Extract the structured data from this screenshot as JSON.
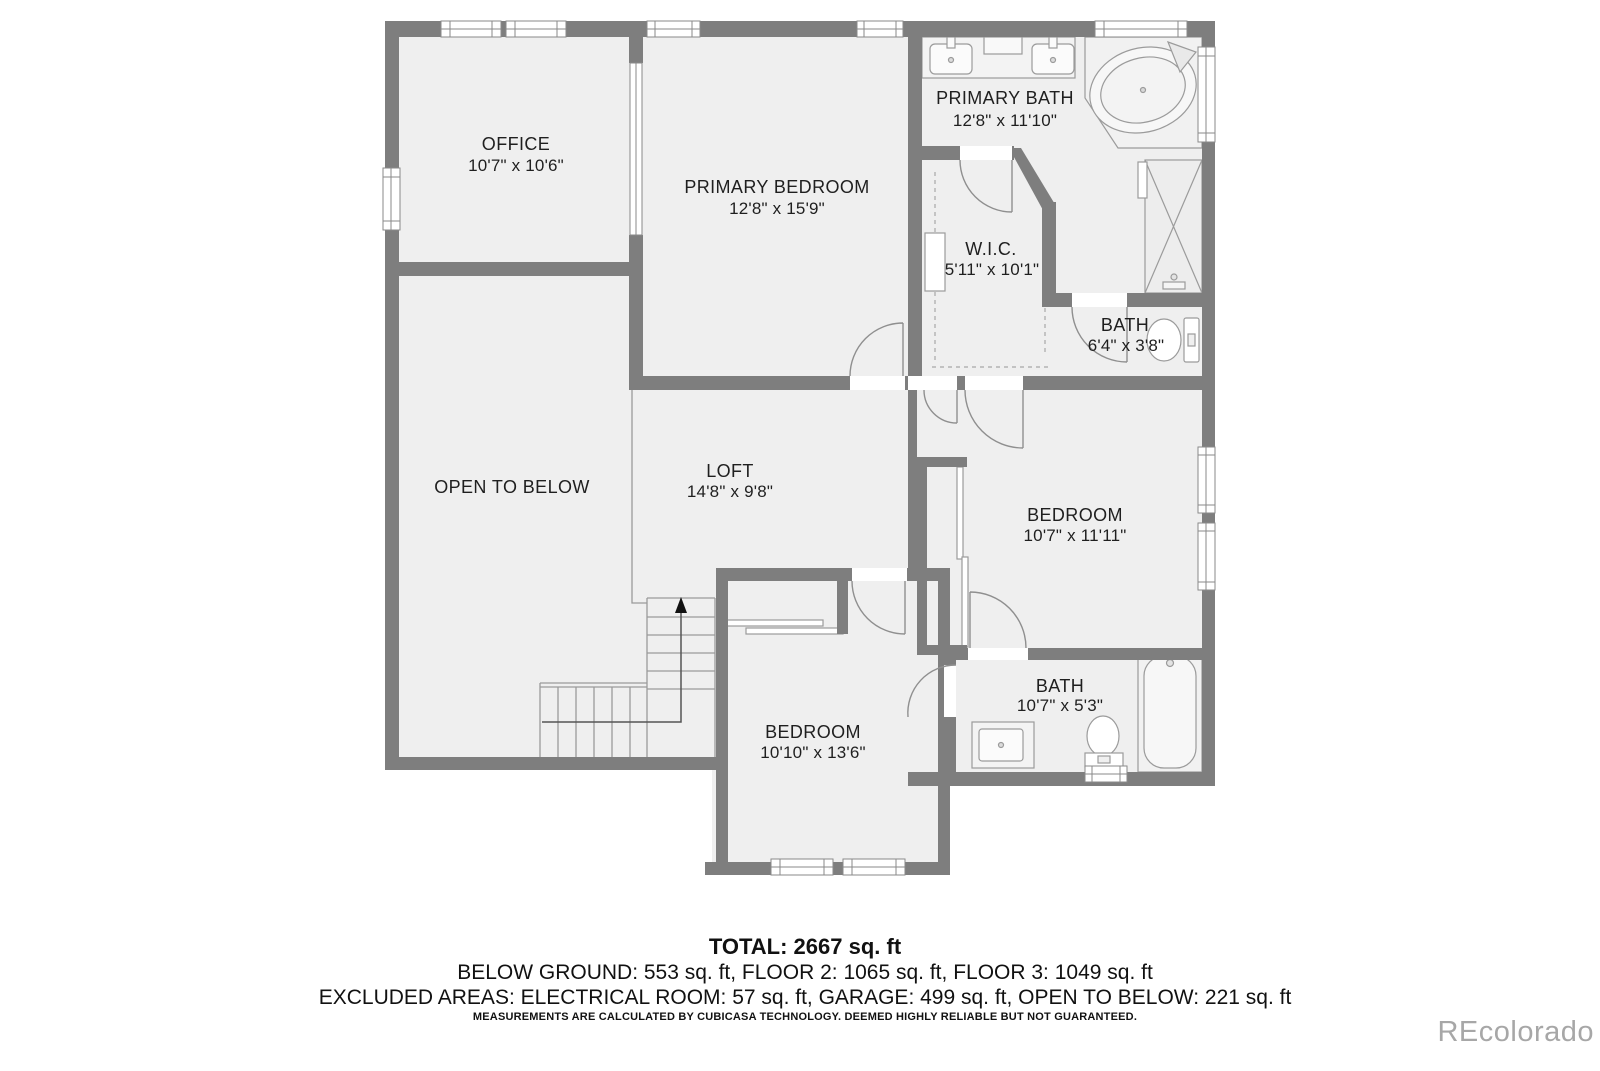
{
  "plan": {
    "rooms": [
      {
        "name": "OFFICE",
        "dims": "10'7\" x 10'6\""
      },
      {
        "name": "PRIMARY BEDROOM",
        "dims": "12'8\" x 15'9\""
      },
      {
        "name": "PRIMARY BATH",
        "dims": "12'8\" x 11'10\""
      },
      {
        "name": "W.I.C.",
        "dims": "5'11\" x 10'1\""
      },
      {
        "name": "BATH",
        "dims": "6'4\" x 3'8\""
      },
      {
        "name": "OPEN TO BELOW",
        "dims": ""
      },
      {
        "name": "LOFT",
        "dims": "14'8\" x 9'8\""
      },
      {
        "name": "BEDROOM",
        "dims": "10'7\" x 11'11\""
      },
      {
        "name": "BATH",
        "dims": "10'7\" x 5'3\""
      },
      {
        "name": "BEDROOM",
        "dims": "10'10\" x 13'6\""
      }
    ]
  },
  "footer": {
    "total": "TOTAL: 2667 sq. ft",
    "floors": "BELOW GROUND: 553 sq. ft, FLOOR 2: 1065 sq. ft, FLOOR 3: 1049 sq. ft",
    "excluded": "EXCLUDED AREAS: ELECTRICAL ROOM: 57 sq. ft, GARAGE: 499 sq. ft, OPEN TO BELOW: 221 sq. ft",
    "disclaimer": "MEASUREMENTS ARE CALCULATED BY CUBICASA TECHNOLOGY. DEEMED HIGHLY RELIABLE BUT NOT GUARANTEED."
  },
  "watermark": "REcolorado",
  "colors": {
    "wall": "#7e7e7e",
    "floor": "#efefef",
    "line": "#8f8f8f",
    "label": "#1f1f1f",
    "watermark": "#a7a7a7"
  }
}
